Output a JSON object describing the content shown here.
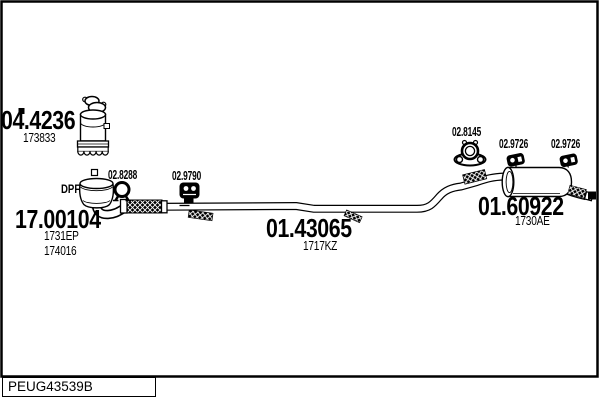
{
  "page": {
    "background": "#ffffff",
    "line_color": "#000000"
  },
  "diagram": {
    "code": "PEUG43539B",
    "parts": {
      "catalyst": {
        "number": "04.4236",
        "ref1": "173833"
      },
      "dpf": {
        "tag": "DPF",
        "number": "17.00104",
        "ref1": "1731EP",
        "ref2": "174016"
      },
      "centre_pipe": {
        "number": "01.43065",
        "ref1": "1717KZ"
      },
      "rear_silencer": {
        "number": "01.60922",
        "ref1": "1730AE"
      }
    },
    "fittings": {
      "clamp": {
        "number": "02.8288",
        "icon": "pipe-clamp-icon"
      },
      "mount": {
        "number": "02.9790",
        "icon": "rubber-mount-icon"
      },
      "gasket": {
        "number": "02.8145",
        "icon": "flange-gasket-icon"
      },
      "hanger_front": {
        "number": "02.9726",
        "icon": "rubber-hanger-icon"
      },
      "hanger_rear": {
        "number": "02.9726",
        "icon": "rubber-hanger-icon"
      }
    }
  }
}
